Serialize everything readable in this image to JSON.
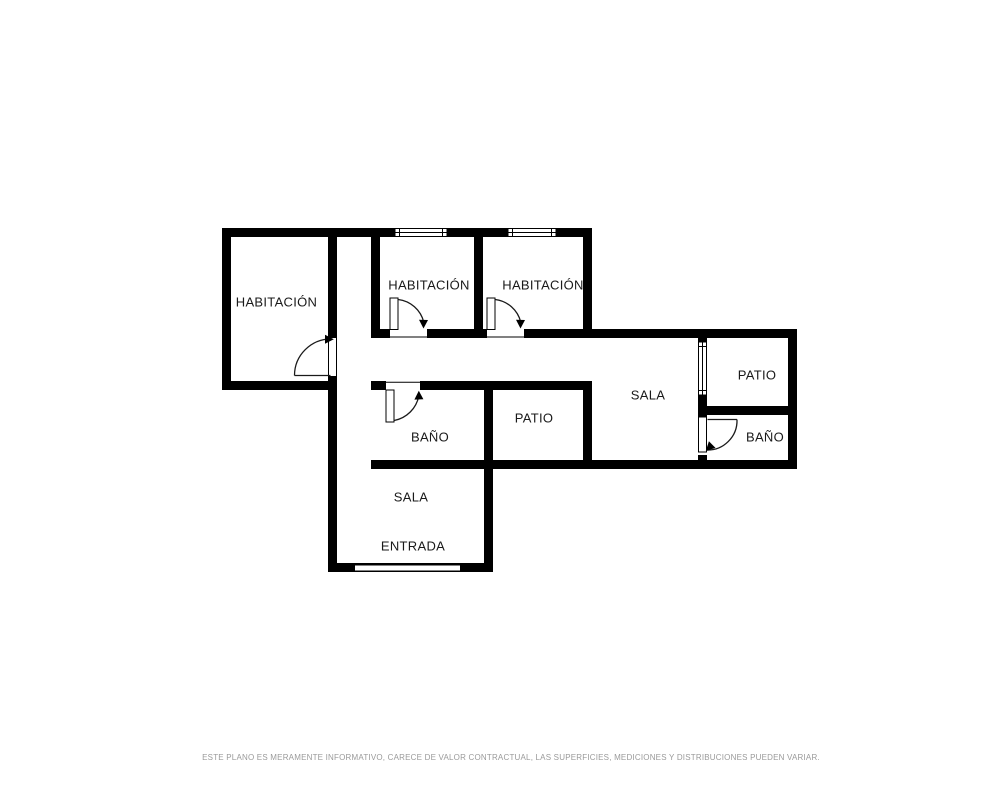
{
  "rooms": [
    {
      "id": "habitacion-left",
      "label": "HABITACIÓN"
    },
    {
      "id": "habitacion-middle",
      "label": "HABITACIÓN"
    },
    {
      "id": "habitacion-right",
      "label": "HABITACIÓN"
    },
    {
      "id": "bano-middle",
      "label": "BAÑO"
    },
    {
      "id": "patio-middle",
      "label": "PATIO"
    },
    {
      "id": "sala-right",
      "label": "SALA"
    },
    {
      "id": "patio-right",
      "label": "PATIO"
    },
    {
      "id": "bano-right",
      "label": "BAÑO"
    },
    {
      "id": "sala-bottom",
      "label": "SALA"
    },
    {
      "id": "entrada",
      "label": "ENTRADA"
    }
  ],
  "disclaimer": "ESTE PLANO ES MERAMENTE INFORMATIVO, CARECE DE VALOR CONTRACTUAL, LAS SUPERFICIES, MEDICIONES Y DISTRIBUCIONES PUEDEN VARIAR.",
  "colors": {
    "wall": "#000000",
    "background": "#ffffff",
    "label": "#1a1a1a",
    "disclaimer": "#9a9a9a"
  },
  "symbols": {
    "door": "door-swing-icon",
    "window": "window-icon",
    "entrance": "entrance-opening-icon"
  }
}
